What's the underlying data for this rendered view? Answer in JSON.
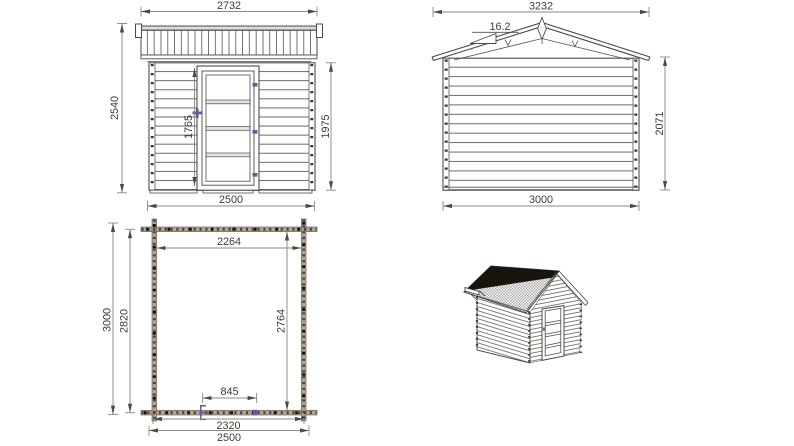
{
  "colors": {
    "line": "#4b4b47",
    "dim_line": "#8a8a84",
    "text": "#3c3c38",
    "wall_hatch": "#b2a593",
    "accent_blue": "#5c5f9e",
    "roof_dark": "#18150f",
    "background": "#ffffff"
  },
  "views": {
    "front": {
      "dims": {
        "roof_width": "2732",
        "overall_height": "2540",
        "door_height": "1765",
        "wall_height": "1975",
        "wall_width": "2500"
      }
    },
    "gable": {
      "dims": {
        "roof_width": "3232",
        "roof_pitch": "16.2",
        "wall_height": "2071",
        "wall_width": "3000"
      }
    },
    "plan": {
      "dims": {
        "inner_width": "2264",
        "outer_depth": "3000",
        "wall_depth": "2820",
        "inner_depth": "2764",
        "door_width": "845",
        "inner_width_bottom": "2320",
        "outer_width": "2500"
      }
    }
  }
}
